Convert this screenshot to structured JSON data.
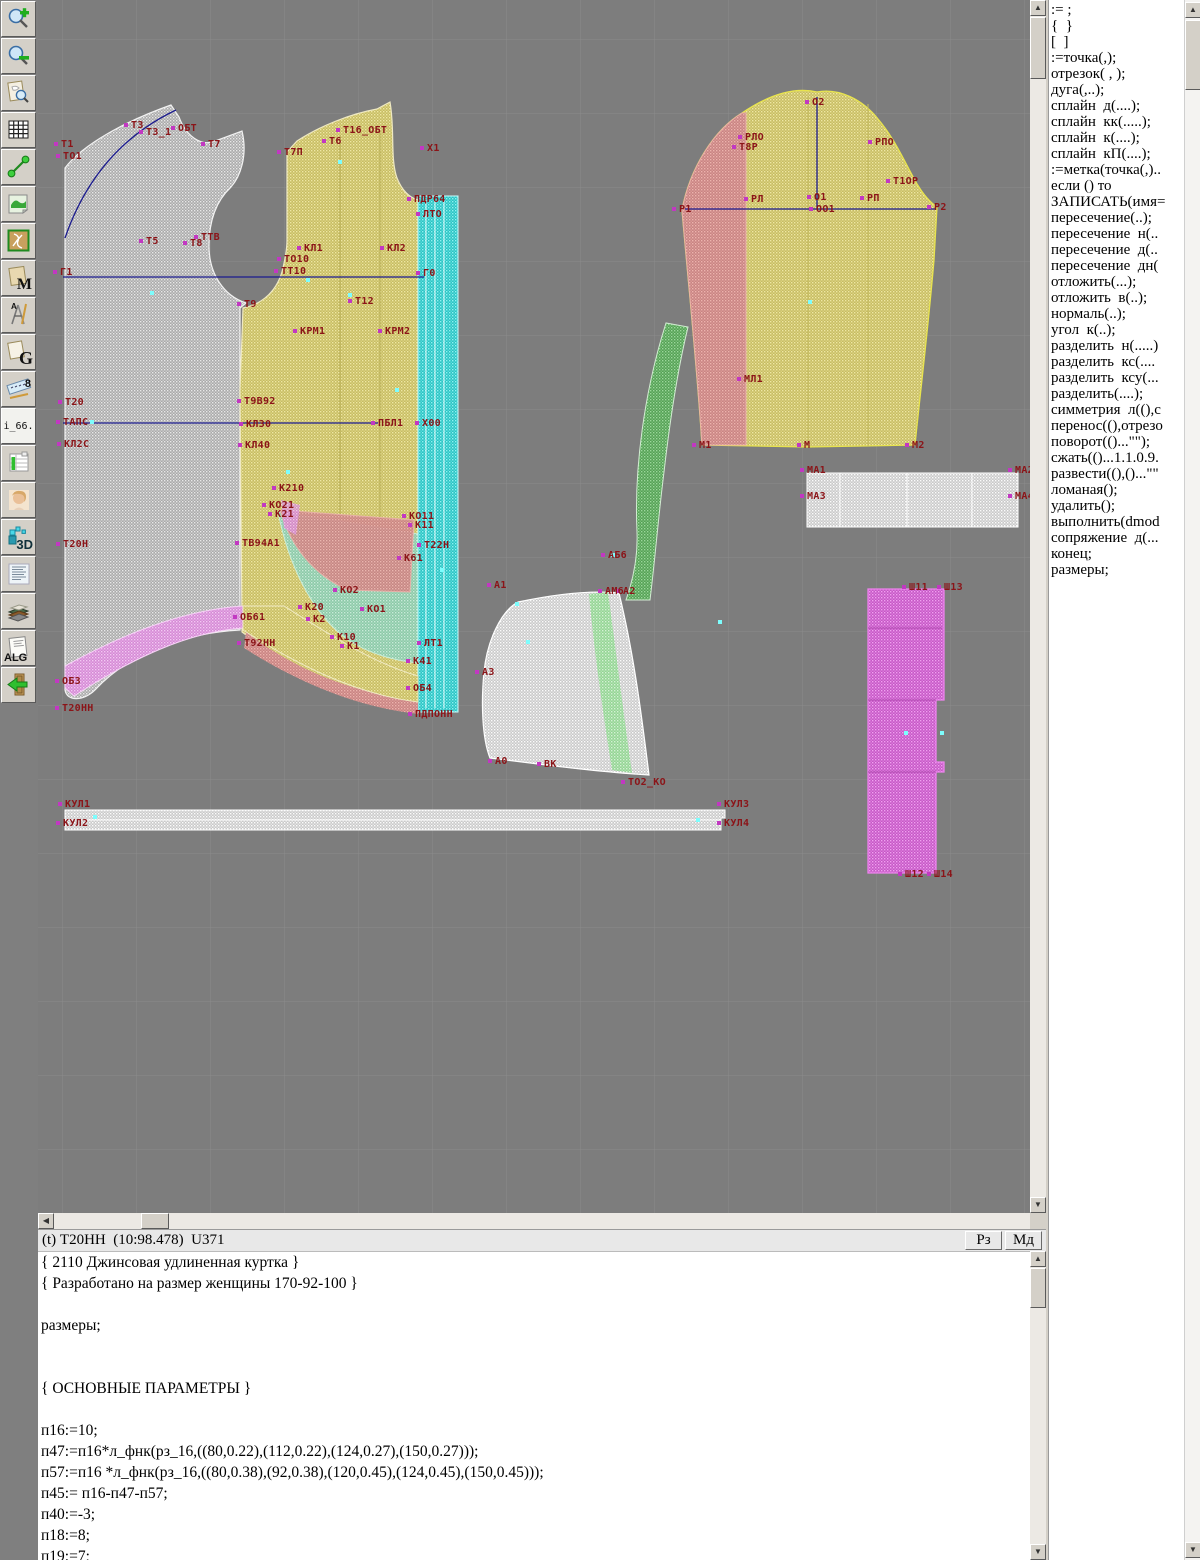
{
  "icons": {
    "up": "▲",
    "down": "▼",
    "left": "◀",
    "right": "▶"
  },
  "toolbar": {
    "items": [
      {
        "name": "zoom-in-button"
      },
      {
        "name": "zoom-out-button"
      },
      {
        "name": "preview-button"
      },
      {
        "name": "grid-button"
      },
      {
        "name": "measure-button"
      },
      {
        "name": "image-button"
      },
      {
        "name": "pattern-frame-button"
      },
      {
        "name": "m-document-button",
        "glyph": "M"
      },
      {
        "name": "drafting-button",
        "glyph": "A"
      },
      {
        "name": "g-document-button",
        "glyph": "G"
      },
      {
        "name": "ruler-button",
        "glyph": "8"
      },
      {
        "name": "i66-button",
        "glyph": "i_66."
      },
      {
        "name": "table-chart-button"
      },
      {
        "name": "portrait-button"
      },
      {
        "name": "threed-button",
        "glyph": "3D"
      },
      {
        "name": "text-list-button"
      },
      {
        "name": "books-button"
      },
      {
        "name": "alg-button",
        "glyph": "ALG"
      },
      {
        "name": "exit-button"
      }
    ]
  },
  "canvas": {
    "colors": {
      "background": "#7d7d7d",
      "grid": "#8b8b8b",
      "label": "#8b1418",
      "construction": "#1b1b8e",
      "back_piece": "#bdbdbd",
      "front_piece": "#d2c878",
      "placket": "#3fd0d0",
      "sleeve_left": "#d29090",
      "sleeve_main": "#d2c878",
      "hood": "#dcdcdc",
      "hood_strip": "#a5dfa5",
      "crescent": "#6db06d",
      "hem_band": "#dd9add",
      "waist_strip": "#dedede",
      "belt": "#d06ad0",
      "cuff": "#dedede"
    },
    "labels": [
      {
        "t": "Т1",
        "x": 23,
        "y": 143
      },
      {
        "t": "ТО1",
        "x": 25,
        "y": 155
      },
      {
        "t": "Т3",
        "x": 93,
        "y": 124
      },
      {
        "t": "Т3_1",
        "x": 108,
        "y": 131
      },
      {
        "t": "ОБТ",
        "x": 140,
        "y": 127
      },
      {
        "t": "Т7",
        "x": 170,
        "y": 143
      },
      {
        "t": "Т5",
        "x": 108,
        "y": 240
      },
      {
        "t": "Т8",
        "x": 152,
        "y": 242
      },
      {
        "t": "ТТВ",
        "x": 163,
        "y": 236
      },
      {
        "t": "Г1",
        "x": 22,
        "y": 271
      },
      {
        "t": "Т9",
        "x": 206,
        "y": 303
      },
      {
        "t": "Т7П",
        "x": 246,
        "y": 151
      },
      {
        "t": "Т6",
        "x": 291,
        "y": 140
      },
      {
        "t": "Т16_ОБТ",
        "x": 305,
        "y": 129
      },
      {
        "t": "Х1",
        "x": 389,
        "y": 147
      },
      {
        "t": "ПДР64",
        "x": 376,
        "y": 198
      },
      {
        "t": "ЛТО",
        "x": 385,
        "y": 213
      },
      {
        "t": "КЛ1",
        "x": 266,
        "y": 247
      },
      {
        "t": "КЛ2",
        "x": 349,
        "y": 247
      },
      {
        "t": "ТО10",
        "x": 246,
        "y": 258
      },
      {
        "t": "ТТ10",
        "x": 243,
        "y": 270
      },
      {
        "t": "Г0",
        "x": 385,
        "y": 272
      },
      {
        "t": "Т12",
        "x": 317,
        "y": 300
      },
      {
        "t": "КРМ1",
        "x": 262,
        "y": 330
      },
      {
        "t": "КРМ2",
        "x": 347,
        "y": 330
      },
      {
        "t": "Т20",
        "x": 27,
        "y": 401
      },
      {
        "t": "ТАПС",
        "x": 25,
        "y": 421
      },
      {
        "t": "КЛ2С",
        "x": 26,
        "y": 443
      },
      {
        "t": "Т9В92",
        "x": 206,
        "y": 400
      },
      {
        "t": "КЛ30",
        "x": 208,
        "y": 423
      },
      {
        "t": "КЛ40",
        "x": 207,
        "y": 444
      },
      {
        "t": "ПБЛ1",
        "x": 340,
        "y": 422
      },
      {
        "t": "Х00",
        "x": 384,
        "y": 422
      },
      {
        "t": "Т20Н",
        "x": 25,
        "y": 543
      },
      {
        "t": "К210",
        "x": 241,
        "y": 487
      },
      {
        "t": "КО21",
        "x": 231,
        "y": 504
      },
      {
        "t": "К21",
        "x": 237,
        "y": 513
      },
      {
        "t": "КО11",
        "x": 371,
        "y": 515
      },
      {
        "t": "К11",
        "x": 377,
        "y": 524
      },
      {
        "t": "Т22Н",
        "x": 386,
        "y": 544
      },
      {
        "t": "К61",
        "x": 366,
        "y": 557
      },
      {
        "t": "ТВ94А1",
        "x": 204,
        "y": 542
      },
      {
        "t": "КО2",
        "x": 302,
        "y": 589
      },
      {
        "t": "К20",
        "x": 267,
        "y": 606
      },
      {
        "t": "К2",
        "x": 275,
        "y": 618
      },
      {
        "t": "КО1",
        "x": 329,
        "y": 608
      },
      {
        "t": "К10",
        "x": 299,
        "y": 636
      },
      {
        "t": "К1",
        "x": 309,
        "y": 645
      },
      {
        "t": "ЛТ1",
        "x": 386,
        "y": 642
      },
      {
        "t": "К41",
        "x": 375,
        "y": 660
      },
      {
        "t": "ОБ4",
        "x": 375,
        "y": 687
      },
      {
        "t": "ОБ61",
        "x": 202,
        "y": 616
      },
      {
        "t": "Т92НН",
        "x": 206,
        "y": 642
      },
      {
        "t": "ОБ3",
        "x": 24,
        "y": 680
      },
      {
        "t": "Т20НН",
        "x": 24,
        "y": 707
      },
      {
        "t": "ПДПОНН",
        "x": 377,
        "y": 713
      },
      {
        "t": "КУЛ1",
        "x": 27,
        "y": 803
      },
      {
        "t": "КУЛ2",
        "x": 25,
        "y": 822
      },
      {
        "t": "КУЛ3",
        "x": 686,
        "y": 803
      },
      {
        "t": "КУЛ4",
        "x": 686,
        "y": 822
      },
      {
        "t": "А1",
        "x": 456,
        "y": 584
      },
      {
        "t": "АМ6",
        "x": 567,
        "y": 590
      },
      {
        "t": "А2",
        "x": 585,
        "y": 590
      },
      {
        "t": "А3",
        "x": 444,
        "y": 671
      },
      {
        "t": "А0",
        "x": 457,
        "y": 760
      },
      {
        "t": "ВК",
        "x": 506,
        "y": 763
      },
      {
        "t": "ТО2_КО",
        "x": 590,
        "y": 781
      },
      {
        "t": "АБ6",
        "x": 570,
        "y": 554
      },
      {
        "t": "О2",
        "x": 774,
        "y": 101
      },
      {
        "t": "РЛО",
        "x": 707,
        "y": 136
      },
      {
        "t": "Т8Р",
        "x": 701,
        "y": 146
      },
      {
        "t": "РПО",
        "x": 837,
        "y": 141
      },
      {
        "t": "Т1ОР",
        "x": 855,
        "y": 180
      },
      {
        "t": "РЛ",
        "x": 713,
        "y": 198
      },
      {
        "t": "О1",
        "x": 776,
        "y": 196
      },
      {
        "t": "ОО1",
        "x": 778,
        "y": 208
      },
      {
        "t": "РП",
        "x": 829,
        "y": 197
      },
      {
        "t": "Р1",
        "x": 641,
        "y": 208
      },
      {
        "t": "Р2",
        "x": 896,
        "y": 206
      },
      {
        "t": "МЛ1",
        "x": 706,
        "y": 378
      },
      {
        "t": "М1",
        "x": 661,
        "y": 444
      },
      {
        "t": "М",
        "x": 766,
        "y": 444
      },
      {
        "t": "М2",
        "x": 874,
        "y": 444
      },
      {
        "t": "МА1",
        "x": 769,
        "y": 469
      },
      {
        "t": "МА3",
        "x": 769,
        "y": 495
      },
      {
        "t": "МА2",
        "x": 977,
        "y": 469
      },
      {
        "t": "МА4",
        "x": 977,
        "y": 495
      },
      {
        "t": "Ш11",
        "x": 871,
        "y": 586
      },
      {
        "t": "Ш13",
        "x": 906,
        "y": 586
      },
      {
        "t": "Ш12",
        "x": 867,
        "y": 873
      },
      {
        "t": "Ш14",
        "x": 896,
        "y": 873
      }
    ],
    "markers": [
      [
        112,
        291
      ],
      [
        310,
        293
      ],
      [
        268,
        278
      ],
      [
        357,
        388
      ],
      [
        402,
        568
      ],
      [
        488,
        640
      ],
      [
        573,
        553
      ],
      [
        866,
        731
      ],
      [
        52,
        420
      ],
      [
        658,
        818
      ],
      [
        300,
        160
      ],
      [
        770,
        300
      ],
      [
        477,
        602
      ],
      [
        248,
        470
      ],
      [
        680,
        620
      ],
      [
        55,
        815
      ],
      [
        902,
        731
      ]
    ]
  },
  "right_panel": {
    "commands": [
      ":= ;",
      "{  }",
      "[  ]",
      ":=точка(,);",
      "отрезок( , );",
      "дуга(,..);",
      "сплайн  д(....);",
      "сплайн  кк(.....);",
      "сплайн  к(....);",
      "сплайн  кП(....);",
      ":=метка(точка(,)..",
      "если () то",
      "ЗАПИСАТЬ(имя=",
      "пересечение(..);",
      "пересечение  н(..",
      "пересечение  д(..",
      "пересечение  дн(",
      "отложить(...);",
      "отложить  в(..);",
      "нормаль(..);",
      "угол  к(..);",
      "разделить  н(.....)",
      "разделить  кс(....",
      "разделить  ксу(...",
      "разделить(....);",
      "симметрия  л((),с",
      "перенос((),отрезо",
      "поворот(()...\"\");",
      "сжать(()...1.1.0.9.",
      "развести((),()...\"\"",
      "ломаная();",
      "удалить();",
      "выполнить(dmod",
      "сопряжение  д(...",
      "конец;",
      "размеры;"
    ]
  },
  "status_bar": {
    "text": "(t) Т20НН  (10:98.478)  U371",
    "buttons": [
      {
        "label": "Рз"
      },
      {
        "label": "Мд"
      }
    ]
  },
  "editor": {
    "lines": [
      "{ 2110 Джинсовая удлиненная куртка }",
      "{ Разработано на размер женщины 170-92-100 }",
      "",
      "размеры;",
      "",
      "",
      "{ ОСНОВНЫЕ ПАРАМЕТРЫ }",
      "",
      "п16:=10;",
      "п47:=п16*л_фнк(рз_16,((80,0.22),(112,0.22),(124,0.27),(150,0.27)));",
      "п57:=п16 *л_фнк(рз_16,((80,0.38),(92,0.38),(120,0.45),(124,0.45),(150,0.45)));",
      "п45:= п16-п47-п57;",
      "п40:=-3;",
      "п18:=8;",
      "п19:=7;"
    ]
  }
}
